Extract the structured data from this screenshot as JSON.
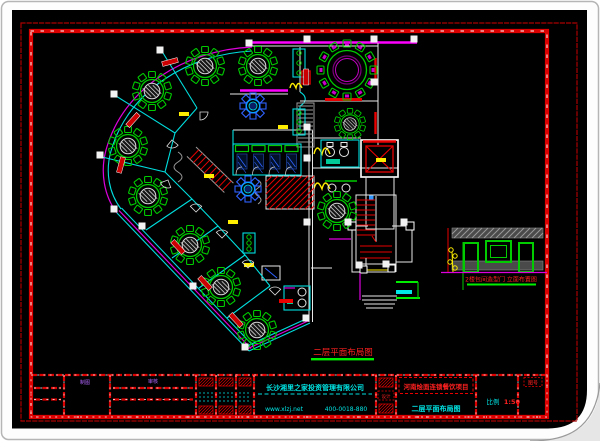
{
  "sheet": {
    "plan_caption": "二层平面布局图",
    "elevation_caption": "2楼包间造型门 立面布置图"
  },
  "titleblock": {
    "company": "长沙湘里之家投资管理有限公司",
    "website": "www.xlzj.net",
    "phone": "400-0018-880",
    "draft_label": "制图",
    "review_label": "审核",
    "stamp_label": "设计",
    "project": "河南烩面连锁餐饮项目",
    "drawing_title": "二层平面布局图",
    "scale_label": "比例",
    "scale_value": "1:50",
    "sheet_no_label": "图号"
  },
  "colors": {
    "paper": "#ffffff",
    "canvas": "#000000",
    "border_red": "#dd0000",
    "wall_cyan": "#00dede",
    "wall_magenta": "#ff00ff",
    "table_green": "#00cc00",
    "fixture_blue": "#2f62ff",
    "mark_yellow": "#ffee00",
    "text_cyan": "#00e5e5",
    "text_red": "#ff2020"
  },
  "plan": {
    "tables": [
      {
        "x": 205,
        "y": 66,
        "s": 1
      },
      {
        "x": 258,
        "y": 66,
        "s": 1
      },
      {
        "x": 152,
        "y": 91,
        "s": 1
      },
      {
        "x": 128,
        "y": 146,
        "s": 1
      },
      {
        "x": 148,
        "y": 196,
        "s": 1
      },
      {
        "x": 190,
        "y": 245,
        "s": 1
      },
      {
        "x": 221,
        "y": 287,
        "s": 1
      },
      {
        "x": 257,
        "y": 330,
        "s": 1
      },
      {
        "x": 337,
        "y": 211,
        "s": 1
      },
      {
        "x": 350,
        "y": 124,
        "s": 0.8
      }
    ],
    "big_table": {
      "x": 347,
      "y": 70
    },
    "flowers": [
      [
        253,
        106
      ],
      [
        248,
        189
      ]
    ],
    "columns": [
      [
        249,
        43
      ],
      [
        160,
        50
      ],
      [
        114,
        94
      ],
      [
        100,
        155
      ],
      [
        114,
        209
      ],
      [
        142,
        226
      ],
      [
        193,
        286
      ],
      [
        245,
        347
      ],
      [
        307,
        39
      ],
      [
        374,
        39
      ],
      [
        414,
        39
      ],
      [
        374,
        82
      ],
      [
        307,
        127
      ],
      [
        307,
        158
      ],
      [
        307,
        222
      ],
      [
        306,
        318
      ],
      [
        348,
        222
      ],
      [
        404,
        222
      ],
      [
        359,
        265
      ],
      [
        386,
        264
      ]
    ],
    "yellow_marks": [
      [
        184,
        114
      ],
      [
        209,
        176
      ],
      [
        233,
        222
      ],
      [
        249,
        265
      ],
      [
        283,
        127
      ],
      [
        381,
        160
      ]
    ],
    "red_bars": [
      [
        170,
        62,
        -15
      ],
      [
        133,
        120,
        -48
      ],
      [
        121,
        165,
        -75
      ],
      [
        178,
        247,
        47
      ],
      [
        205,
        283,
        47
      ],
      [
        236,
        320,
        47
      ],
      [
        306,
        77,
        90
      ]
    ],
    "door_arcs": [
      [
        200,
        112,
        0
      ],
      [
        172,
        140,
        40
      ],
      [
        168,
        180,
        70
      ],
      [
        196,
        212,
        225
      ],
      [
        222,
        238,
        225
      ],
      [
        248,
        268,
        225
      ],
      [
        275,
        295,
        225
      ]
    ],
    "partitions": [
      [
        146,
        230,
        192,
        199
      ],
      [
        172,
        258,
        218,
        226
      ],
      [
        199,
        288,
        245,
        255
      ],
      [
        227,
        318,
        270,
        286
      ],
      [
        163,
        53,
        197,
        108
      ],
      [
        116,
        96,
        175,
        133
      ],
      [
        102,
        157,
        165,
        172
      ]
    ],
    "inner_wall": [
      [
        197,
        108
      ],
      [
        175,
        133
      ],
      [
        165,
        172
      ],
      [
        192,
        199
      ],
      [
        218,
        226
      ],
      [
        245,
        255
      ],
      [
        270,
        286
      ]
    ],
    "booth_row": {
      "x": 234,
      "y": 144,
      "n": 4,
      "w": 16.5,
      "h": 31
    }
  },
  "titleblock_geo": {
    "frame": [
      31,
      375,
      547,
      417
    ],
    "verticals": [
      64,
      110,
      196,
      216,
      236,
      254,
      376,
      396,
      476,
      518
    ],
    "stamp_cells": [
      [
        196,
        216
      ],
      [
        216,
        236
      ],
      [
        236,
        254
      ]
    ]
  }
}
